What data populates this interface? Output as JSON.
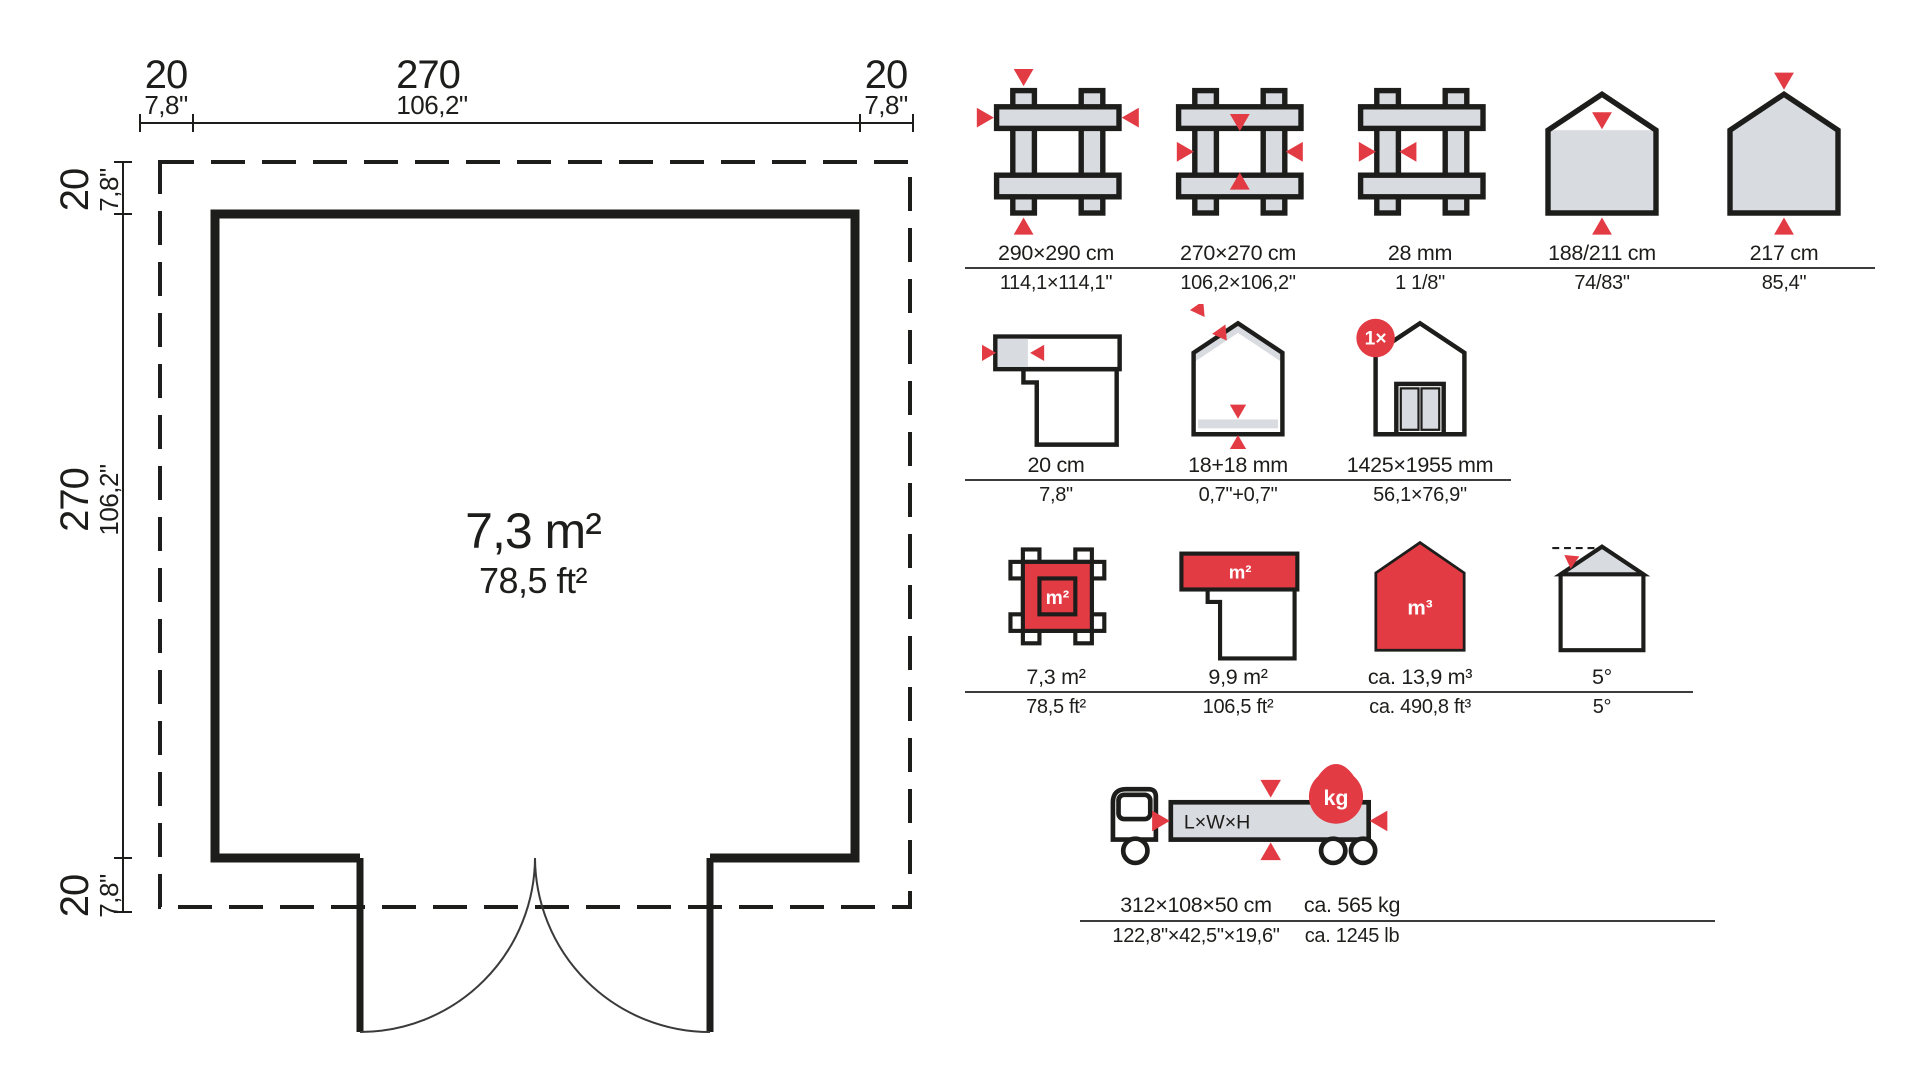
{
  "floor_plan": {
    "area_primary": "7,3 m²",
    "area_secondary": "78,5 ft²",
    "dims_top": [
      {
        "primary": "20",
        "secondary": "7,8\""
      },
      {
        "primary": "270",
        "secondary": "106,2\""
      },
      {
        "primary": "20",
        "secondary": "7,8\""
      }
    ],
    "dims_left": [
      {
        "primary": "20",
        "secondary": "7,8\""
      },
      {
        "primary": "270",
        "secondary": "106,2\""
      },
      {
        "primary": "20",
        "secondary": "7,8\""
      }
    ]
  },
  "specs": {
    "rows": [
      {
        "items": [
          {
            "icon": "outer-dimensions-icon",
            "metric": "290×290 cm",
            "imperial": "114,1×114,1\""
          },
          {
            "icon": "inner-dimensions-icon",
            "metric": "270×270 cm",
            "imperial": "106,2×106,2\""
          },
          {
            "icon": "wall-thickness-icon",
            "metric": "28 mm",
            "imperial": "1 1/8\""
          },
          {
            "icon": "eave-ridge-height-icon",
            "metric": "188/211 cm",
            "imperial": "74/83\""
          },
          {
            "icon": "total-height-icon",
            "metric": "217 cm",
            "imperial": "85,4\""
          }
        ]
      },
      {
        "items": [
          {
            "icon": "roof-overhang-icon",
            "metric": "20 cm",
            "imperial": "7,8\""
          },
          {
            "icon": "roof-floor-thickness-icon",
            "metric": "18+18 mm",
            "imperial": "0,7\"+0,7\""
          },
          {
            "icon": "door-size-icon",
            "metric": "1425×1955 mm",
            "imperial": "56,1×76,9\"",
            "badge": "1×"
          }
        ]
      },
      {
        "items": [
          {
            "icon": "floor-area-icon",
            "metric": "7,3 m²",
            "imperial": "78,5 ft²",
            "unit_label": "m²"
          },
          {
            "icon": "roof-area-icon",
            "metric": "9,9 m²",
            "imperial": "106,5 ft²",
            "unit_label": "m²"
          },
          {
            "icon": "volume-icon",
            "metric": "ca. 13,9 m³",
            "imperial": "ca. 490,8 ft³",
            "unit_label": "m³"
          },
          {
            "icon": "roof-pitch-icon",
            "metric": "5°",
            "imperial": "5°"
          }
        ]
      },
      {
        "items": [
          {
            "icon": "transport-dimensions-icon",
            "metric": "312×108×50 cm",
            "imperial": "122,8\"×42,5\"×19,6\"",
            "package_label": "L×W×H"
          },
          {
            "icon": "transport-weight-icon",
            "metric": "ca. 565 kg",
            "imperial": "ca. 1245 lb",
            "unit_label": "kg"
          }
        ]
      }
    ]
  },
  "colors": {
    "accent": "#e23b44",
    "icon_fill": "#d8dbe0",
    "line": "#1d1d1b"
  }
}
